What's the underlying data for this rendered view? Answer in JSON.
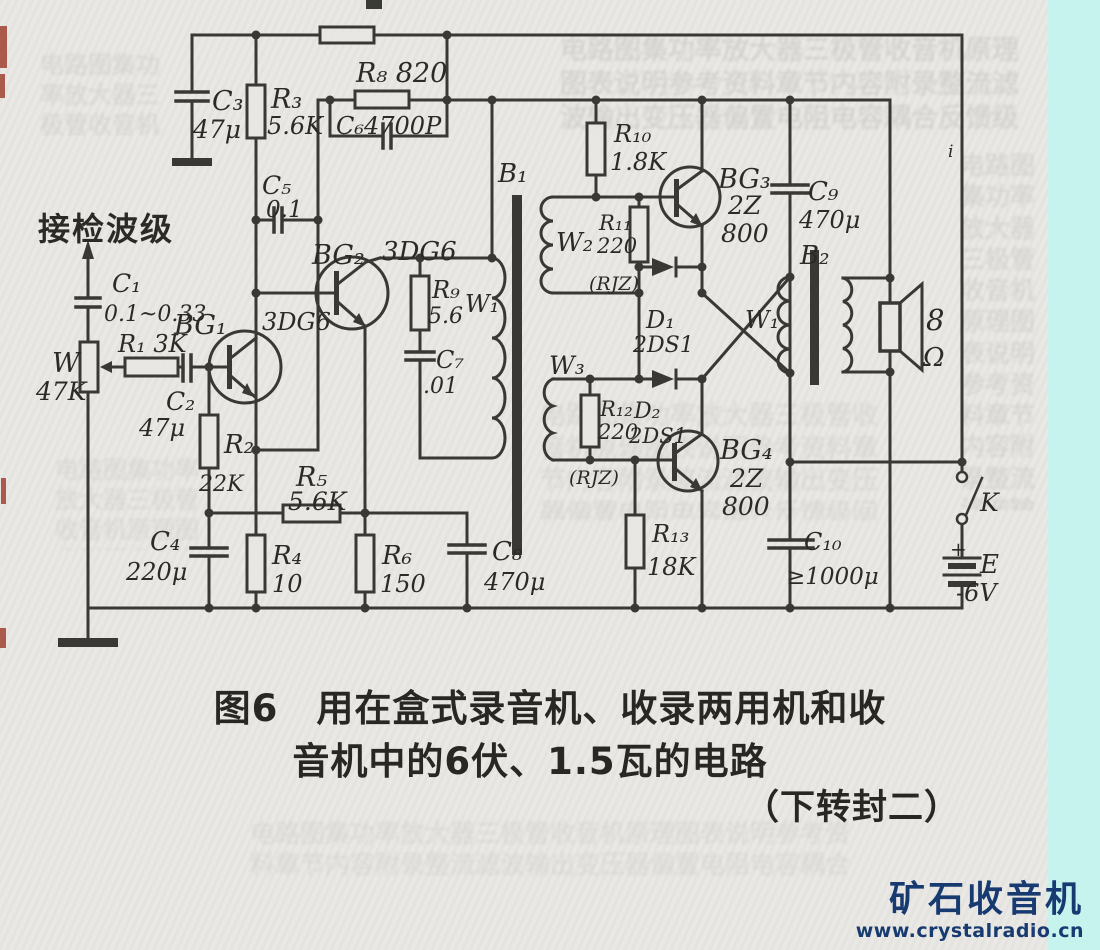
{
  "figure": {
    "caption_line1": "图6　用在盒式录音机、收录两用机和收",
    "caption_line2": "音机中的6伏、1.5瓦的电路",
    "caption_line3": "（下转封二）"
  },
  "watermark": {
    "title": "矿石收音机",
    "url": "www.crystalradio.cn"
  },
  "colors": {
    "ink": "#2b2a26",
    "paper": "#e8e7e3",
    "cyan_strip": "#c6f3ee",
    "watermark_navy": "#173a70",
    "edge_red": "#a04130"
  },
  "schematic": {
    "input_label": "接检波级",
    "transistors": [
      "BG₁ 3DG6",
      "BG₂ 3DG6",
      "BG₃ 2Z800",
      "BG₄ 2Z800"
    ],
    "labels": [
      {
        "id": "input",
        "t": "接检波级",
        "x": 38,
        "y": 240,
        "s": 32,
        "cjk": true
      },
      {
        "id": "c3",
        "t": "C₃",
        "x": 212,
        "y": 110,
        "s": 27
      },
      {
        "id": "c3v",
        "t": "47μ",
        "x": 193,
        "y": 138,
        "s": 25
      },
      {
        "id": "r3",
        "t": "R₃",
        "x": 271,
        "y": 108,
        "s": 27
      },
      {
        "id": "r3v",
        "t": "5.6K",
        "x": 267,
        "y": 134,
        "s": 24
      },
      {
        "id": "c5",
        "t": "C₅",
        "x": 262,
        "y": 194,
        "s": 25
      },
      {
        "id": "c5v",
        "t": "0.1",
        "x": 266,
        "y": 217,
        "s": 23
      },
      {
        "id": "r8",
        "t": "R₈ 820",
        "x": 356,
        "y": 82,
        "s": 27
      },
      {
        "id": "c6",
        "t": "C₆4700P",
        "x": 336,
        "y": 134,
        "s": 24
      },
      {
        "id": "bg2",
        "t": "BG₂",
        "x": 312,
        "y": 264,
        "s": 27
      },
      {
        "id": "bg2t",
        "t": "3DG6",
        "x": 382,
        "y": 260,
        "s": 26
      },
      {
        "id": "c1",
        "t": "C₁",
        "x": 112,
        "y": 292,
        "s": 25
      },
      {
        "id": "c1v",
        "t": "0.1~0.33",
        "x": 104,
        "y": 321,
        "s": 22
      },
      {
        "id": "w",
        "t": "W",
        "x": 52,
        "y": 372,
        "s": 27
      },
      {
        "id": "wv",
        "t": "47K",
        "x": 36,
        "y": 400,
        "s": 25
      },
      {
        "id": "r1",
        "t": "R₁ 3K",
        "x": 118,
        "y": 352,
        "s": 24
      },
      {
        "id": "bg1",
        "t": "BG₁",
        "x": 174,
        "y": 334,
        "s": 27
      },
      {
        "id": "bg1t",
        "t": "3DG6",
        "x": 262,
        "y": 330,
        "s": 24
      },
      {
        "id": "c2",
        "t": "C₂",
        "x": 166,
        "y": 410,
        "s": 25
      },
      {
        "id": "c2v",
        "t": "47μ",
        "x": 139,
        "y": 436,
        "s": 24
      },
      {
        "id": "r2",
        "t": "R₂",
        "x": 224,
        "y": 453,
        "s": 26
      },
      {
        "id": "r2v",
        "t": "22K",
        "x": 199,
        "y": 491,
        "s": 22
      },
      {
        "id": "c4",
        "t": "C₄",
        "x": 150,
        "y": 550,
        "s": 26
      },
      {
        "id": "c4v",
        "t": "220μ",
        "x": 126,
        "y": 580,
        "s": 24
      },
      {
        "id": "r4",
        "t": "R₄",
        "x": 272,
        "y": 564,
        "s": 26
      },
      {
        "id": "r4v",
        "t": "10",
        "x": 272,
        "y": 592,
        "s": 24
      },
      {
        "id": "r5",
        "t": "R₅",
        "x": 296,
        "y": 486,
        "s": 27
      },
      {
        "id": "r5v",
        "t": "5.6K",
        "x": 288,
        "y": 510,
        "s": 25
      },
      {
        "id": "r6",
        "t": "R₆",
        "x": 382,
        "y": 564,
        "s": 26
      },
      {
        "id": "r6v",
        "t": "150",
        "x": 380,
        "y": 592,
        "s": 24
      },
      {
        "id": "c8",
        "t": "C₈",
        "x": 492,
        "y": 560,
        "s": 26
      },
      {
        "id": "c8v",
        "t": "470μ",
        "x": 484,
        "y": 590,
        "s": 24
      },
      {
        "id": "b1",
        "t": "B₁",
        "x": 498,
        "y": 182,
        "s": 26
      },
      {
        "id": "r9",
        "t": "R₉",
        "x": 432,
        "y": 298,
        "s": 24
      },
      {
        "id": "r9v",
        "t": "5.6",
        "x": 428,
        "y": 323,
        "s": 22
      },
      {
        "id": "w1a",
        "t": "W₁",
        "x": 465,
        "y": 312,
        "s": 24
      },
      {
        "id": "c7",
        "t": "C₇",
        "x": 436,
        "y": 368,
        "s": 24
      },
      {
        "id": "c7v",
        "t": ".01",
        "x": 423,
        "y": 393,
        "s": 22
      },
      {
        "id": "r10",
        "t": "R₁₀",
        "x": 614,
        "y": 142,
        "s": 24
      },
      {
        "id": "r10v",
        "t": "1.8K",
        "x": 610,
        "y": 170,
        "s": 24
      },
      {
        "id": "w2",
        "t": "W₂",
        "x": 556,
        "y": 251,
        "s": 26
      },
      {
        "id": "r11",
        "t": "R₁₁",
        "x": 599,
        "y": 230,
        "s": 21
      },
      {
        "id": "r11v",
        "t": "220",
        "x": 597,
        "y": 253,
        "s": 21
      },
      {
        "id": "rjz1",
        "t": "(RJZ)",
        "x": 589,
        "y": 290,
        "s": 19
      },
      {
        "id": "d1",
        "t": "D₁",
        "x": 646,
        "y": 328,
        "s": 24
      },
      {
        "id": "d1v",
        "t": "2DS1",
        "x": 633,
        "y": 352,
        "s": 22
      },
      {
        "id": "bg3",
        "t": "BG₃",
        "x": 718,
        "y": 188,
        "s": 27
      },
      {
        "id": "bg3a",
        "t": "2Z",
        "x": 728,
        "y": 214,
        "s": 25
      },
      {
        "id": "bg3b",
        "t": "800",
        "x": 721,
        "y": 242,
        "s": 25
      },
      {
        "id": "w3",
        "t": "W₃",
        "x": 549,
        "y": 374,
        "s": 25
      },
      {
        "id": "r12",
        "t": "R₁₂",
        "x": 600,
        "y": 416,
        "s": 21
      },
      {
        "id": "r12v",
        "t": "220",
        "x": 598,
        "y": 439,
        "s": 21
      },
      {
        "id": "d2",
        "t": "D₂",
        "x": 634,
        "y": 418,
        "s": 22
      },
      {
        "id": "d2v",
        "t": "2DS1",
        "x": 629,
        "y": 443,
        "s": 21
      },
      {
        "id": "rjz2",
        "t": "(RJZ)",
        "x": 569,
        "y": 484,
        "s": 19
      },
      {
        "id": "bg4",
        "t": "BG₄",
        "x": 720,
        "y": 459,
        "s": 27
      },
      {
        "id": "bg4a",
        "t": "2Z",
        "x": 730,
        "y": 487,
        "s": 25
      },
      {
        "id": "bg4b",
        "t": "800",
        "x": 722,
        "y": 515,
        "s": 25
      },
      {
        "id": "r13",
        "t": "R₁₃",
        "x": 652,
        "y": 542,
        "s": 24
      },
      {
        "id": "r13v",
        "t": "18K",
        "x": 647,
        "y": 575,
        "s": 24
      },
      {
        "id": "w1b",
        "t": "W₁",
        "x": 745,
        "y": 328,
        "s": 24
      },
      {
        "id": "b2",
        "t": "B₂",
        "x": 800,
        "y": 264,
        "s": 26
      },
      {
        "id": "c9",
        "t": "C₉",
        "x": 808,
        "y": 200,
        "s": 26
      },
      {
        "id": "c9v",
        "t": "470μ",
        "x": 799,
        "y": 228,
        "s": 24
      },
      {
        "id": "spk8",
        "t": "8",
        "x": 926,
        "y": 330,
        "s": 29
      },
      {
        "id": "spkohm",
        "t": "Ω",
        "x": 923,
        "y": 366,
        "s": 26
      },
      {
        "id": "c10",
        "t": "C₁₀",
        "x": 804,
        "y": 550,
        "s": 24
      },
      {
        "id": "c10v",
        "t": "≥1000μ",
        "x": 786,
        "y": 584,
        "s": 23
      },
      {
        "id": "k",
        "t": "K",
        "x": 980,
        "y": 511,
        "s": 25
      },
      {
        "id": "plus",
        "t": "+",
        "x": 950,
        "y": 556,
        "s": 20,
        "up": true
      },
      {
        "id": "e",
        "t": "E",
        "x": 980,
        "y": 573,
        "s": 26
      },
      {
        "id": "ev",
        "t": "-6V",
        "x": 956,
        "y": 601,
        "s": 24
      },
      {
        "id": "imark",
        "t": "i",
        "x": 948,
        "y": 157,
        "s": 17
      }
    ]
  },
  "artifacts": {
    "bleed_filler": "电路图集功率放大器三极管收音机原理图表说明参考资料章节内容附录整流滤波输出变压器偏置电阻电容耦合反馈级间推挽放大喇叭电池开关二极管稳压检波中周线圈磁芯绕组匝数比值计算公式"
  }
}
